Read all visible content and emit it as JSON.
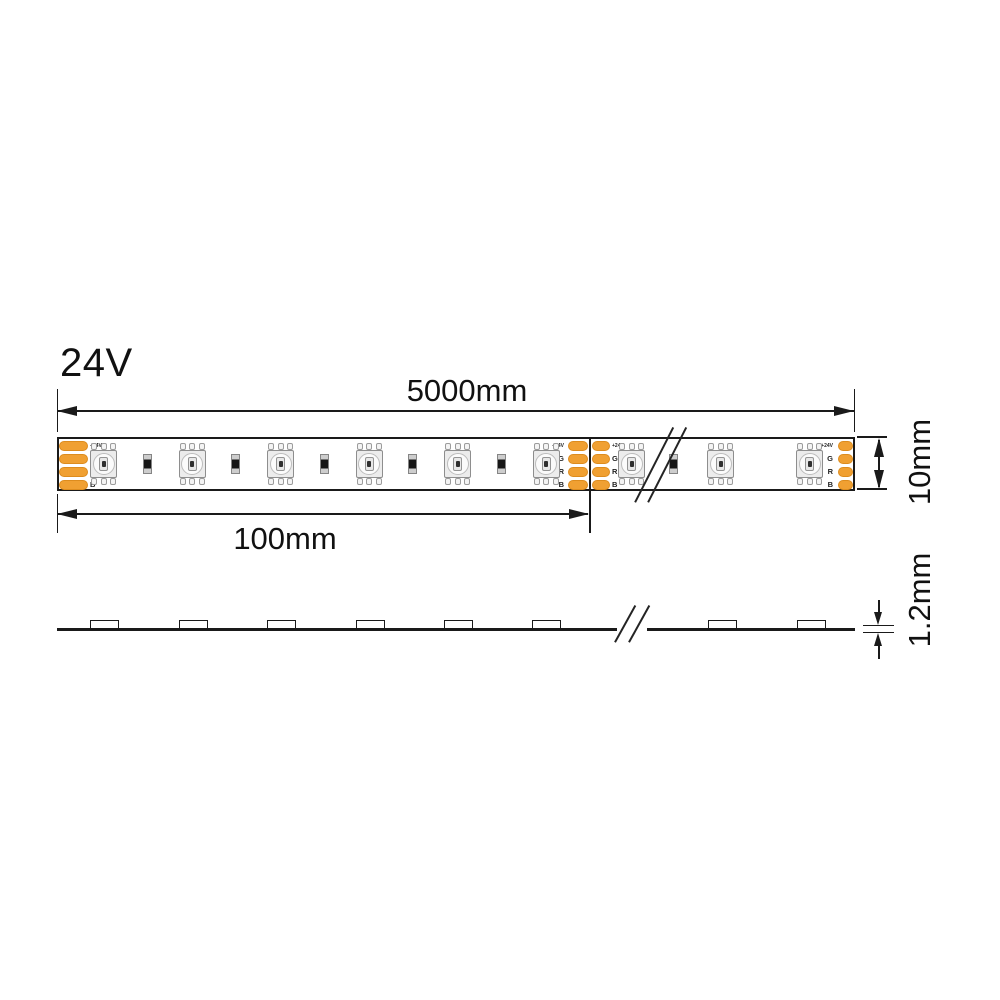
{
  "title": "24V",
  "dimensions": {
    "total_length": "5000mm",
    "cut_length": "100mm",
    "width": "10mm",
    "thickness": "1.2mm"
  },
  "strip": {
    "pad_labels": [
      "+24V",
      "G",
      "R",
      "B"
    ],
    "led_count_top_view": 9,
    "resistor_count_top_view": 6,
    "led_count_side_view": 8
  },
  "colors": {
    "ink": "#1a1a1a",
    "pad_fill": "#F0A032",
    "pad_border": "#DD8C1E"
  },
  "diagram": {
    "top_view": {
      "led_centers_x": [
        44.5,
        133,
        221.5,
        310,
        398.5,
        487,
        572.5,
        661.5,
        750.5
      ],
      "resistor_centers_x": [
        88,
        176.5,
        265,
        353.5,
        442,
        614
      ],
      "pad_groups": [
        {
          "x": 0,
          "w": 29,
          "label_side": "right",
          "label_x": 31
        },
        {
          "x": 509,
          "w": 20,
          "label_side": "left",
          "label_x": 485
        },
        {
          "x": 533,
          "w": 18,
          "label_side": "right",
          "label_x": 553
        },
        {
          "x": 779,
          "w": 15,
          "label_side": "left",
          "label_x": 754
        }
      ]
    },
    "side_view": {
      "led_centers_x": [
        104,
        193,
        281,
        370,
        458,
        546,
        722,
        811
      ]
    }
  }
}
